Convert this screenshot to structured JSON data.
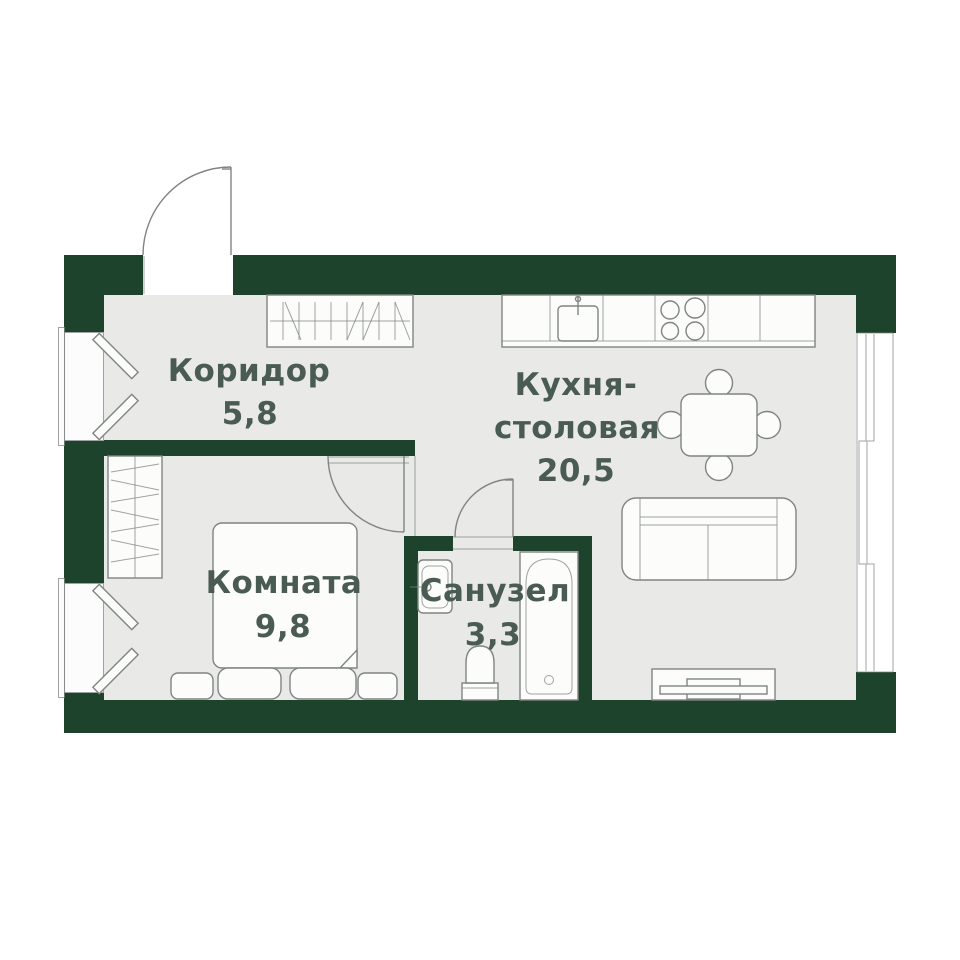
{
  "rooms": {
    "corridor": {
      "name": "Коридор",
      "area": "5,8"
    },
    "kitchen": {
      "name_line1": "Кухня-",
      "name_line2": "столовая",
      "area": "20,5"
    },
    "bedroom": {
      "name": "Комната",
      "area": "9,8"
    },
    "bathroom": {
      "name": "Санузел",
      "area": "3,3"
    }
  },
  "colors": {
    "wall": "#1d432c",
    "floor": "#e9e9e7",
    "text": "#4a5b54",
    "line": "#7f8583",
    "fixture": "#fcfcfb",
    "bg": "#ffffff"
  }
}
